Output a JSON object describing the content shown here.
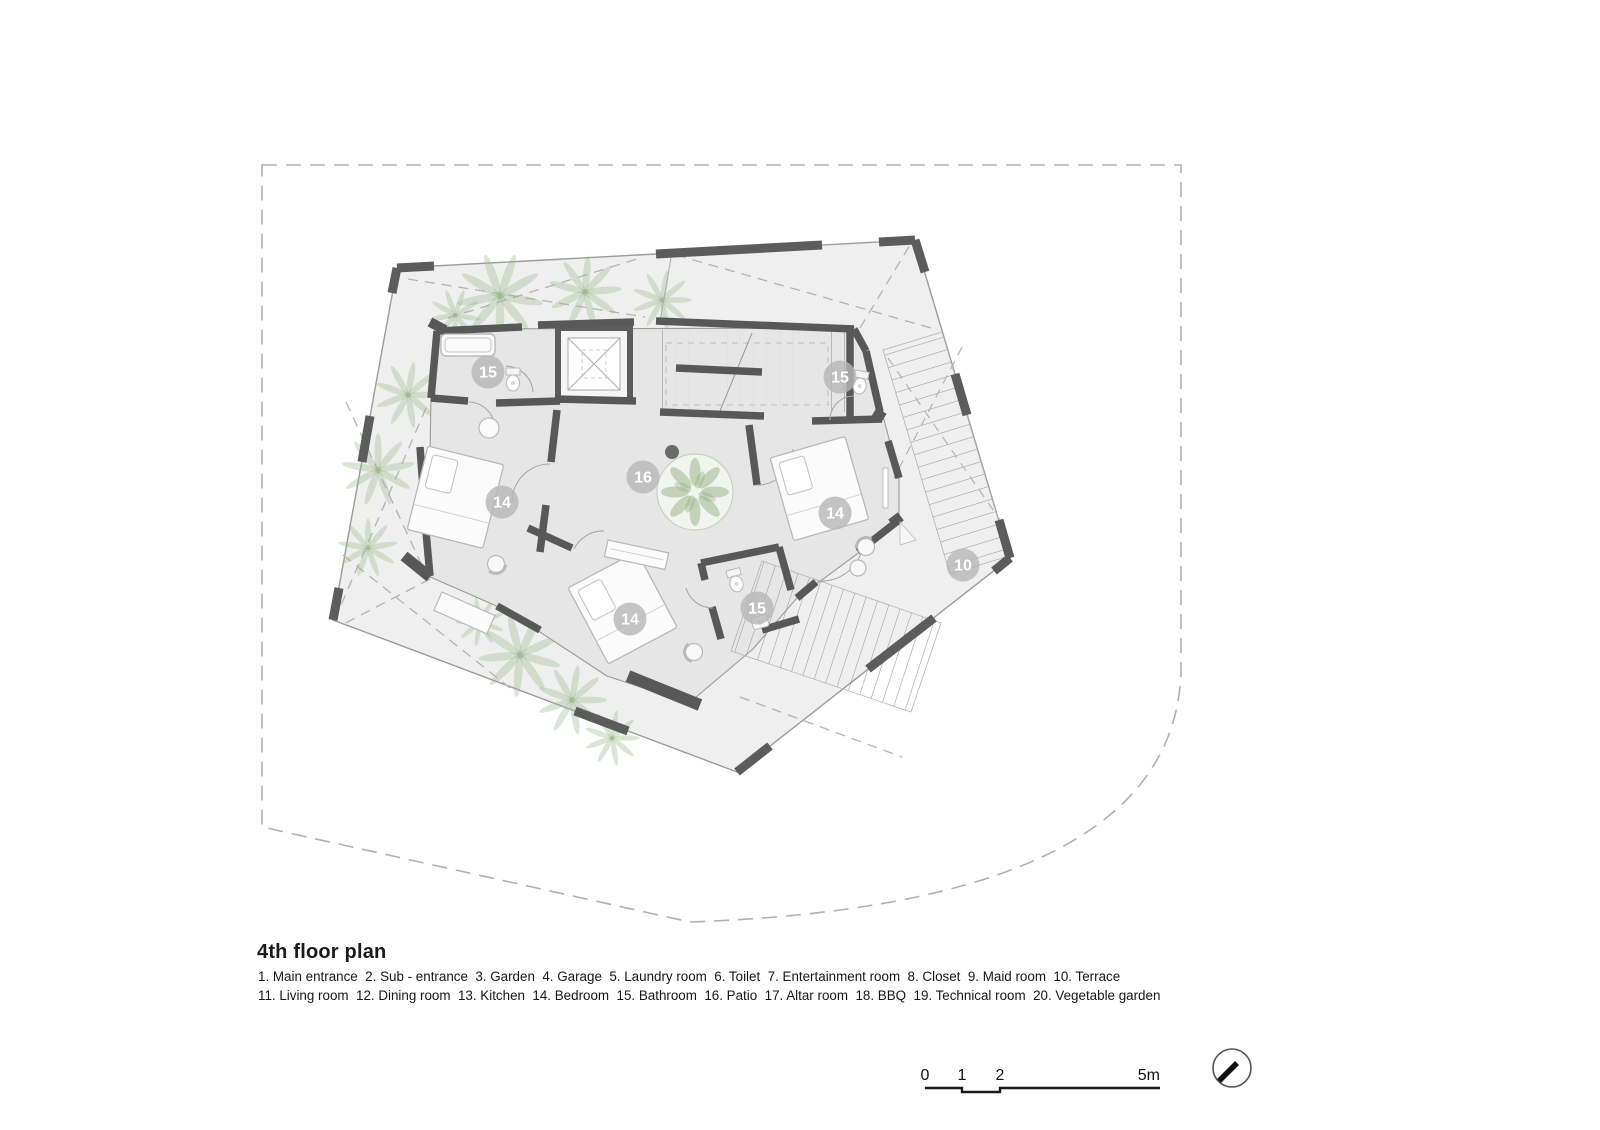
{
  "title": "4th floor plan",
  "legend": {
    "line1": "1. Main entrance  2. Sub - entrance  3. Garden  4. Garage  5. Laundry room  6. Toilet  7. Entertainment room  8. Closet  9. Maid room  10. Terrace",
    "line2": "11. Living room  12. Dining room  13. Kitchen  14. Bedroom  15. Bathroom  16. Patio  17. Altar room  18. BBQ  19. Technical room  20. Vegetable garden"
  },
  "plan": {
    "room_labels": [
      {
        "number": "15",
        "room": "Bathroom"
      },
      {
        "number": "15",
        "room": "Bathroom"
      },
      {
        "number": "14",
        "room": "Bedroom"
      },
      {
        "number": "16",
        "room": "Patio"
      },
      {
        "number": "14",
        "room": "Bedroom"
      },
      {
        "number": "10",
        "room": "Terrace"
      },
      {
        "number": "15",
        "room": "Bathroom"
      },
      {
        "number": "14",
        "room": "Bedroom"
      }
    ]
  },
  "scale_bar": {
    "ticks": [
      "0",
      "1",
      "2",
      "5m"
    ]
  },
  "icons": {
    "north_arrow": "compass-circle-with-needle"
  },
  "colors": {
    "wall": "#585858",
    "footprint_fill": "#efefef",
    "room_fill": "#e6e6e6",
    "plant_green": "#9cbb8c",
    "boundary_dash": "#b0b0b0",
    "label_circle": "#b7b7b7",
    "text": "#1b1b1b"
  }
}
